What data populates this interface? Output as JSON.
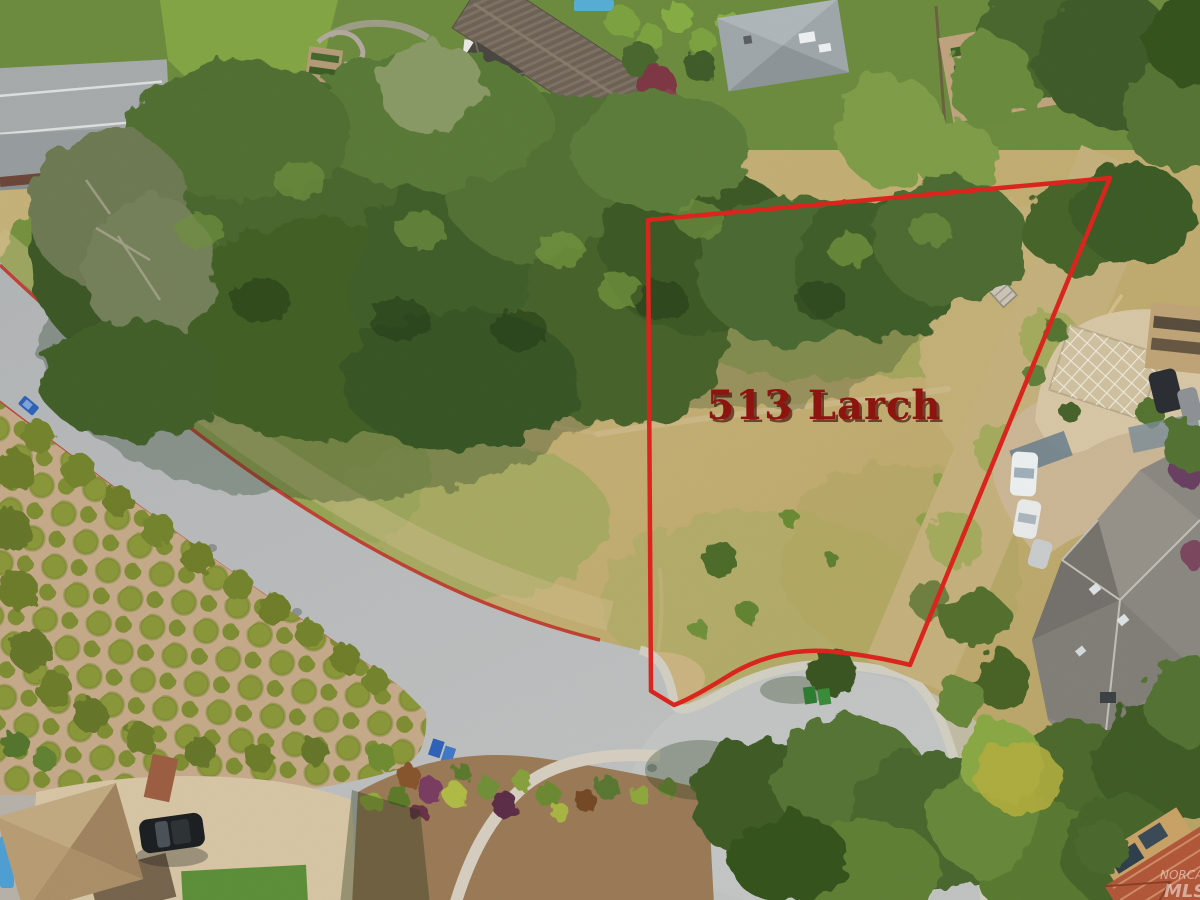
{
  "photo": {
    "type": "aerial-drone-photo-of-vacant-lot",
    "annotation": {
      "label": "513 Larch",
      "label_color": "#8e1410",
      "label_shadow_color": "#430a06",
      "boundary_color": "#d9251d"
    },
    "watermark": {
      "line1": "NORCAL",
      "line2": "MLS",
      "color": "#ffffff"
    }
  },
  "palette": {
    "asphalt": "#b6b9ba",
    "curb_red": "#c03527",
    "dry_grass": "#c0ad74",
    "oak_green": "#44602c",
    "concrete_tan": "#cdbb98",
    "dirt": "#c5aa8a"
  }
}
